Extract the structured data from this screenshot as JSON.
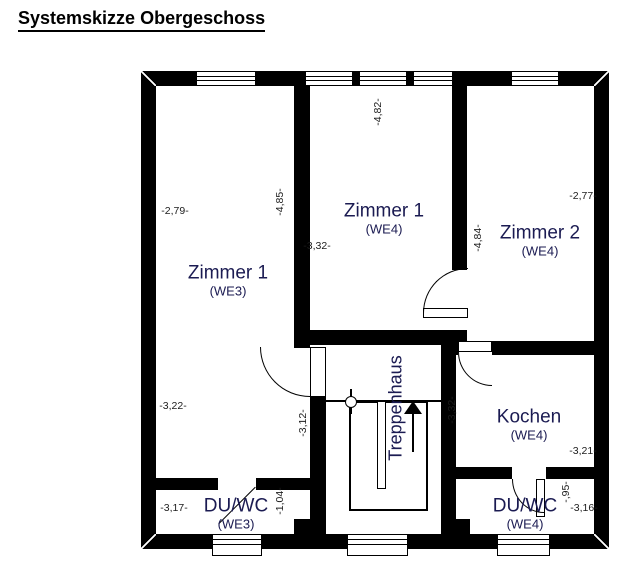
{
  "title": "Systemskizze Obergeschoss",
  "rooms": {
    "zimmer1_we3": {
      "name": "Zimmer 1",
      "unit": "(WE3)"
    },
    "zimmer1_we4": {
      "name": "Zimmer 1",
      "unit": "(WE4)"
    },
    "zimmer2_we4": {
      "name": "Zimmer 2",
      "unit": "(WE4)"
    },
    "kochen_we4": {
      "name": "Kochen",
      "unit": "(WE4)"
    },
    "duwc_we3": {
      "name": "DU/WC",
      "unit": "(WE3)"
    },
    "duwc_we4": {
      "name": "DU/WC",
      "unit": "(WE4)"
    },
    "treppenhaus": {
      "name": "Treppenhaus"
    }
  },
  "dimensions": {
    "we3_width_top": "-2,79-",
    "we3_height_right": "-4,85-",
    "we3_width_bottom": "-3,22-",
    "duwc_we3_width": "-3,17-",
    "duwc_we3_depth": "-1,04-",
    "we4_zimmer1_height": "-4,82-",
    "we4_zimmer1_width": "-3,32-",
    "flur_height": "-3,12-",
    "treppenhaus_right": "-3,32-",
    "zimmer2_height_left": "-4,84-",
    "zimmer2_width": "-2,77-",
    "kochen_width": "-3,21-",
    "duwc_we4_width": "-3,16-",
    "duwc_we4_depth": "-,95-"
  },
  "colors": {
    "wall": "#000000",
    "label_text": "#1b1b52",
    "background": "#ffffff"
  }
}
